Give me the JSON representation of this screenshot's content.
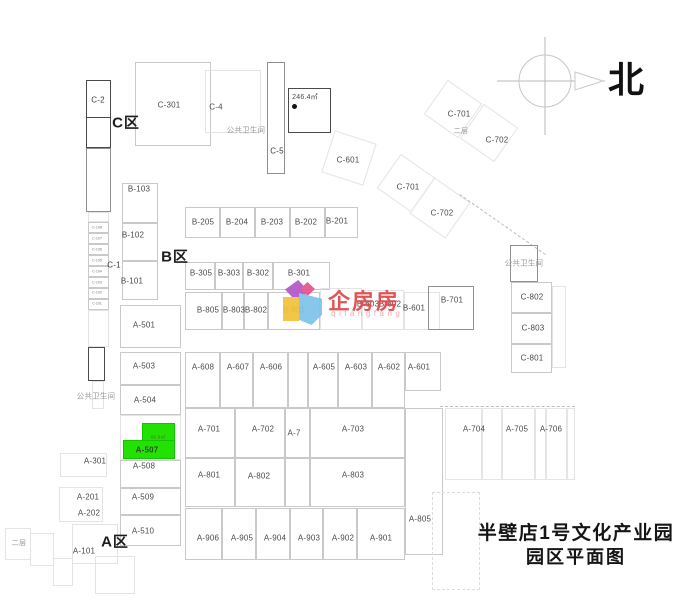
{
  "title": {
    "line1": "半壁店1号文化产业园",
    "line2": "园区平面图"
  },
  "north": {
    "label": "北"
  },
  "watermark": {
    "brand": "企房房",
    "latin": "qifangfang"
  },
  "highlight": {
    "unit": "A-507",
    "area": "66.9㎡"
  },
  "colors": {
    "highlight_green": "#23e103",
    "watermark_red": "#e0474b",
    "title_black": "#151515"
  },
  "labels": [
    {
      "t": "C-2",
      "x": 98,
      "y": 100,
      "c": "s"
    },
    {
      "t": "C区",
      "x": 126,
      "y": 122,
      "c": "zone",
      "n": "zone-c-label"
    },
    {
      "t": "C-301",
      "x": 169,
      "y": 105
    },
    {
      "t": "C-4",
      "x": 216,
      "y": 107
    },
    {
      "t": "公共卫生间",
      "x": 246,
      "y": 130,
      "c": "gray",
      "n": "public-toilet-top-label"
    },
    {
      "t": "C-5",
      "x": 277,
      "y": 151,
      "c": "s"
    },
    {
      "t": "246.4㎡",
      "x": 305,
      "y": 97,
      "c": "xs",
      "n": "area-246-label"
    },
    {
      "t": "C-601",
      "x": 348,
      "y": 160
    },
    {
      "t": "C-701",
      "x": 459,
      "y": 114
    },
    {
      "t": "二层",
      "x": 461,
      "y": 131,
      "c": "xs gray",
      "n": "second-floor-top-label"
    },
    {
      "t": "C-702",
      "x": 497,
      "y": 140
    },
    {
      "t": "C-701",
      "x": 408,
      "y": 187,
      "n": "label-c-701-lower"
    },
    {
      "t": "C-702",
      "x": 442,
      "y": 213,
      "n": "label-c-702-lower"
    },
    {
      "t": "C-1",
      "x": 114,
      "y": 265,
      "c": "s"
    },
    {
      "t": "C-108",
      "x": 97,
      "y": 228,
      "c": "tiny"
    },
    {
      "t": "C-107",
      "x": 97,
      "y": 239,
      "c": "tiny"
    },
    {
      "t": "C-106",
      "x": 97,
      "y": 250,
      "c": "tiny"
    },
    {
      "t": "C-105",
      "x": 97,
      "y": 261,
      "c": "tiny"
    },
    {
      "t": "C-104",
      "x": 97,
      "y": 272,
      "c": "tiny"
    },
    {
      "t": "C-103",
      "x": 97,
      "y": 283,
      "c": "tiny"
    },
    {
      "t": "C-102",
      "x": 97,
      "y": 293,
      "c": "tiny"
    },
    {
      "t": "C-101",
      "x": 97,
      "y": 304,
      "c": "tiny"
    },
    {
      "t": "B-103",
      "x": 139,
      "y": 189
    },
    {
      "t": "B-102",
      "x": 133,
      "y": 235
    },
    {
      "t": "B区",
      "x": 175,
      "y": 256,
      "c": "zone",
      "n": "zone-b-label"
    },
    {
      "t": "B-101",
      "x": 132,
      "y": 281
    },
    {
      "t": "B-205",
      "x": 203,
      "y": 222
    },
    {
      "t": "B-204",
      "x": 237,
      "y": 222
    },
    {
      "t": "B-203",
      "x": 272,
      "y": 222
    },
    {
      "t": "B-202",
      "x": 306,
      "y": 222
    },
    {
      "t": "B-201",
      "x": 337,
      "y": 221
    },
    {
      "t": "B-305",
      "x": 201,
      "y": 273
    },
    {
      "t": "B-303",
      "x": 229,
      "y": 273
    },
    {
      "t": "B-302",
      "x": 258,
      "y": 273
    },
    {
      "t": "B-301",
      "x": 299,
      "y": 273
    },
    {
      "t": "B-805",
      "x": 208,
      "y": 310
    },
    {
      "t": "B-803",
      "x": 234,
      "y": 310
    },
    {
      "t": "B-802",
      "x": 256,
      "y": 310
    },
    {
      "t": "B-801",
      "x": 294,
      "y": 310
    },
    {
      "t": "B-603",
      "x": 368,
      "y": 304
    },
    {
      "t": "B-602",
      "x": 390,
      "y": 304
    },
    {
      "t": "B-601",
      "x": 414,
      "y": 308
    },
    {
      "t": "B-701",
      "x": 452,
      "y": 300
    },
    {
      "t": "公共卫生间",
      "x": 524,
      "y": 263,
      "c": "gray",
      "n": "public-toilet-right-label"
    },
    {
      "t": "C-802",
      "x": 532,
      "y": 297
    },
    {
      "t": "C-803",
      "x": 533,
      "y": 328
    },
    {
      "t": "C-801",
      "x": 532,
      "y": 358
    },
    {
      "t": "A-501",
      "x": 144,
      "y": 325
    },
    {
      "t": "A-503",
      "x": 144,
      "y": 366
    },
    {
      "t": "A-504",
      "x": 145,
      "y": 400
    },
    {
      "t": "公共卫生间",
      "x": 96,
      "y": 396,
      "c": "gray",
      "n": "public-toilet-left-label"
    },
    {
      "t": "66.9㎡",
      "x": 158,
      "y": 437,
      "c": "hla",
      "n": "highlight-area-label"
    },
    {
      "t": "A-507",
      "x": 147,
      "y": 450,
      "c": "hl",
      "n": "highlight-unit-label"
    },
    {
      "t": "A-508",
      "x": 144,
      "y": 466
    },
    {
      "t": "A-509",
      "x": 143,
      "y": 497
    },
    {
      "t": "A-510",
      "x": 143,
      "y": 531
    },
    {
      "t": "A-301",
      "x": 95,
      "y": 461
    },
    {
      "t": "A-201",
      "x": 88,
      "y": 497
    },
    {
      "t": "A-202",
      "x": 89,
      "y": 513
    },
    {
      "t": "A区",
      "x": 115,
      "y": 541,
      "c": "zone",
      "n": "zone-a-label"
    },
    {
      "t": "A-101",
      "x": 84,
      "y": 551
    },
    {
      "t": "二层",
      "x": 19,
      "y": 543,
      "c": "xs gray",
      "n": "second-floor-bottom-label"
    },
    {
      "t": "A-608",
      "x": 203,
      "y": 367
    },
    {
      "t": "A-607",
      "x": 238,
      "y": 367
    },
    {
      "t": "A-606",
      "x": 271,
      "y": 367
    },
    {
      "t": "A-605",
      "x": 324,
      "y": 367
    },
    {
      "t": "A-603",
      "x": 356,
      "y": 367
    },
    {
      "t": "A-602",
      "x": 389,
      "y": 367
    },
    {
      "t": "A-601",
      "x": 419,
      "y": 367
    },
    {
      "t": "A-701",
      "x": 209,
      "y": 429
    },
    {
      "t": "A-702",
      "x": 263,
      "y": 429
    },
    {
      "t": "A-7",
      "x": 294,
      "y": 433
    },
    {
      "t": "A-703",
      "x": 353,
      "y": 429
    },
    {
      "t": "A-704",
      "x": 474,
      "y": 429
    },
    {
      "t": "A-705",
      "x": 517,
      "y": 429
    },
    {
      "t": "A-706",
      "x": 551,
      "y": 429
    },
    {
      "t": "A-801",
      "x": 209,
      "y": 475
    },
    {
      "t": "A-802",
      "x": 259,
      "y": 476
    },
    {
      "t": "A-803",
      "x": 353,
      "y": 475
    },
    {
      "t": "A-805",
      "x": 420,
      "y": 519
    },
    {
      "t": "A-906",
      "x": 208,
      "y": 538
    },
    {
      "t": "A-905",
      "x": 242,
      "y": 538
    },
    {
      "t": "A-904",
      "x": 275,
      "y": 538
    },
    {
      "t": "A-903",
      "x": 309,
      "y": 538
    },
    {
      "t": "A-902",
      "x": 343,
      "y": 538
    },
    {
      "t": "A-901",
      "x": 381,
      "y": 538
    }
  ],
  "boxes": [
    {
      "x": 86,
      "y": 80,
      "w": 25,
      "h": 68,
      "c": "d",
      "n": "c-2-strip-outline"
    },
    {
      "x": 86,
      "y": 80,
      "w": 25,
      "h": 38,
      "c": "d"
    },
    {
      "x": 86,
      "y": 148,
      "w": 25,
      "h": 64,
      "c": "m"
    },
    {
      "x": 88,
      "y": 212,
      "w": 21,
      "h": 10,
      "c": "f"
    },
    {
      "x": 88,
      "y": 222,
      "w": 21,
      "h": 11,
      "c": "l"
    },
    {
      "x": 88,
      "y": 233,
      "w": 21,
      "h": 11,
      "c": "l"
    },
    {
      "x": 88,
      "y": 244,
      "w": 21,
      "h": 11,
      "c": "l"
    },
    {
      "x": 88,
      "y": 255,
      "w": 21,
      "h": 11,
      "c": "l"
    },
    {
      "x": 88,
      "y": 266,
      "w": 21,
      "h": 11,
      "c": "l"
    },
    {
      "x": 88,
      "y": 277,
      "w": 21,
      "h": 11,
      "c": "l"
    },
    {
      "x": 88,
      "y": 288,
      "w": 21,
      "h": 11,
      "c": "l"
    },
    {
      "x": 88,
      "y": 299,
      "w": 21,
      "h": 11,
      "c": "l"
    },
    {
      "x": 88,
      "y": 310,
      "w": 21,
      "h": 37,
      "c": "f"
    },
    {
      "x": 88,
      "y": 347,
      "w": 17,
      "h": 34,
      "c": "d",
      "n": "toilet-left-outline"
    },
    {
      "x": 92,
      "y": 381,
      "w": 12,
      "h": 28,
      "c": "f"
    },
    {
      "x": 135,
      "y": 62,
      "w": 76,
      "h": 84,
      "c": "l",
      "n": "c-301-outline"
    },
    {
      "x": 205,
      "y": 70,
      "w": 56,
      "h": 63,
      "c": "f",
      "n": "c-4-outline"
    },
    {
      "x": 267,
      "y": 62,
      "w": 18,
      "h": 112,
      "c": "m",
      "n": "c-5-outline"
    },
    {
      "x": 288,
      "y": 88,
      "w": 43,
      "h": 45,
      "c": "d",
      "n": "area-246-outline"
    },
    {
      "x": 292,
      "y": 104,
      "w": 5,
      "h": 5,
      "c": "dot",
      "n": "area-246-dot"
    },
    {
      "x": 327,
      "y": 136,
      "w": 44,
      "h": 44,
      "c": "f",
      "r": 18,
      "n": "c-601-outline"
    },
    {
      "x": 432,
      "y": 88,
      "w": 42,
      "h": 42,
      "c": "f",
      "r": 35,
      "n": "c-701-outline"
    },
    {
      "x": 468,
      "y": 112,
      "w": 42,
      "h": 42,
      "c": "f",
      "r": 35,
      "n": "c-702-outline"
    },
    {
      "x": 385,
      "y": 162,
      "w": 42,
      "h": 42,
      "c": "f",
      "r": 35,
      "n": "c-701-lower-outline"
    },
    {
      "x": 418,
      "y": 186,
      "w": 44,
      "h": 44,
      "c": "f",
      "r": 35,
      "n": "c-702-lower-outline"
    },
    {
      "x": 450,
      "y": 224,
      "w": 105,
      "h": 1,
      "c": "hdash",
      "r": 35,
      "n": "boundary-dashed-line"
    },
    {
      "x": 122,
      "y": 183,
      "w": 36,
      "h": 40,
      "c": "l",
      "n": "b-103-outline"
    },
    {
      "x": 122,
      "y": 223,
      "w": 36,
      "h": 38,
      "c": "l",
      "n": "b-102-outline"
    },
    {
      "x": 122,
      "y": 261,
      "w": 36,
      "h": 39,
      "c": "l",
      "n": "b-101-outline"
    },
    {
      "x": 185,
      "y": 207,
      "w": 35,
      "h": 31,
      "c": "l"
    },
    {
      "x": 220,
      "y": 207,
      "w": 35,
      "h": 31,
      "c": "l"
    },
    {
      "x": 255,
      "y": 207,
      "w": 35,
      "h": 31,
      "c": "l"
    },
    {
      "x": 290,
      "y": 207,
      "w": 35,
      "h": 31,
      "c": "l"
    },
    {
      "x": 325,
      "y": 207,
      "w": 33,
      "h": 31,
      "c": "l"
    },
    {
      "x": 185,
      "y": 262,
      "w": 30,
      "h": 28,
      "c": "l"
    },
    {
      "x": 215,
      "y": 262,
      "w": 28,
      "h": 28,
      "c": "l"
    },
    {
      "x": 243,
      "y": 262,
      "w": 30,
      "h": 28,
      "c": "l"
    },
    {
      "x": 273,
      "y": 262,
      "w": 57,
      "h": 28,
      "c": "l"
    },
    {
      "x": 185,
      "y": 292,
      "w": 37,
      "h": 38,
      "c": "l"
    },
    {
      "x": 222,
      "y": 292,
      "w": 22,
      "h": 38,
      "c": "l"
    },
    {
      "x": 244,
      "y": 292,
      "w": 24,
      "h": 38,
      "c": "l"
    },
    {
      "x": 268,
      "y": 292,
      "w": 52,
      "h": 38,
      "c": "l"
    },
    {
      "x": 320,
      "y": 288,
      "w": 42,
      "h": 42,
      "c": "f"
    },
    {
      "x": 362,
      "y": 290,
      "w": 42,
      "h": 40,
      "c": "f"
    },
    {
      "x": 404,
      "y": 292,
      "w": 36,
      "h": 38,
      "c": "f"
    },
    {
      "x": 428,
      "y": 286,
      "w": 46,
      "h": 44,
      "c": "m",
      "n": "b-701-outline"
    },
    {
      "x": 510,
      "y": 245,
      "w": 28,
      "h": 37,
      "c": "m",
      "n": "toilet-right-outline"
    },
    {
      "x": 511,
      "y": 282,
      "w": 41,
      "h": 31,
      "c": "l",
      "n": "c-802-outline"
    },
    {
      "x": 511,
      "y": 313,
      "w": 41,
      "h": 31,
      "c": "l",
      "n": "c-803-outline"
    },
    {
      "x": 511,
      "y": 344,
      "w": 41,
      "h": 29,
      "c": "l",
      "n": "c-801-outline"
    },
    {
      "x": 552,
      "y": 286,
      "w": 14,
      "h": 82,
      "c": "f"
    },
    {
      "x": 120,
      "y": 305,
      "w": 61,
      "h": 43,
      "c": "l",
      "n": "a-501-outline"
    },
    {
      "x": 120,
      "y": 352,
      "w": 61,
      "h": 33,
      "c": "l",
      "n": "a-503-outline"
    },
    {
      "x": 120,
      "y": 385,
      "w": 61,
      "h": 30,
      "c": "l",
      "n": "a-504-outline"
    },
    {
      "x": 120,
      "y": 415,
      "w": 61,
      "h": 45,
      "c": "f"
    },
    {
      "x": 120,
      "y": 460,
      "w": 61,
      "h": 28,
      "c": "l",
      "n": "a-508-outline"
    },
    {
      "x": 120,
      "y": 488,
      "w": 61,
      "h": 27,
      "c": "l",
      "n": "a-509-outline"
    },
    {
      "x": 120,
      "y": 515,
      "w": 61,
      "h": 31,
      "c": "l",
      "n": "a-510-outline"
    },
    {
      "x": 142,
      "y": 423,
      "w": 33,
      "h": 18,
      "c": "g",
      "n": "highlighted-unit-a-507",
      "i": true
    },
    {
      "x": 123,
      "y": 440,
      "w": 52,
      "h": 19,
      "c": "g",
      "n": "highlighted-unit-a-507",
      "i": true
    },
    {
      "x": 185,
      "y": 352,
      "w": 35,
      "h": 56,
      "c": "l"
    },
    {
      "x": 220,
      "y": 352,
      "w": 33,
      "h": 56,
      "c": "l"
    },
    {
      "x": 253,
      "y": 352,
      "w": 35,
      "h": 56,
      "c": "l"
    },
    {
      "x": 288,
      "y": 352,
      "w": 20,
      "h": 56,
      "c": "l"
    },
    {
      "x": 308,
      "y": 352,
      "w": 30,
      "h": 56,
      "c": "l"
    },
    {
      "x": 338,
      "y": 352,
      "w": 34,
      "h": 56,
      "c": "l"
    },
    {
      "x": 372,
      "y": 352,
      "w": 33,
      "h": 56,
      "c": "l"
    },
    {
      "x": 405,
      "y": 352,
      "w": 36,
      "h": 39,
      "c": "l",
      "n": "a-601-outline"
    },
    {
      "x": 185,
      "y": 408,
      "w": 50,
      "h": 50,
      "c": "l"
    },
    {
      "x": 235,
      "y": 408,
      "w": 50,
      "h": 50,
      "c": "l"
    },
    {
      "x": 285,
      "y": 408,
      "w": 25,
      "h": 50,
      "c": "l"
    },
    {
      "x": 310,
      "y": 408,
      "w": 95,
      "h": 50,
      "c": "l"
    },
    {
      "x": 185,
      "y": 458,
      "w": 50,
      "h": 49,
      "c": "l"
    },
    {
      "x": 235,
      "y": 458,
      "w": 50,
      "h": 49,
      "c": "l"
    },
    {
      "x": 285,
      "y": 458,
      "w": 25,
      "h": 49,
      "c": "l"
    },
    {
      "x": 310,
      "y": 458,
      "w": 95,
      "h": 49,
      "c": "l"
    },
    {
      "x": 405,
      "y": 408,
      "w": 38,
      "h": 147,
      "c": "l",
      "n": "a-805-outline"
    },
    {
      "x": 185,
      "y": 508,
      "w": 37,
      "h": 52,
      "c": "l"
    },
    {
      "x": 222,
      "y": 508,
      "w": 34,
      "h": 52,
      "c": "l"
    },
    {
      "x": 256,
      "y": 508,
      "w": 34,
      "h": 52,
      "c": "l"
    },
    {
      "x": 290,
      "y": 508,
      "w": 33,
      "h": 52,
      "c": "l"
    },
    {
      "x": 323,
      "y": 508,
      "w": 34,
      "h": 52,
      "c": "l"
    },
    {
      "x": 357,
      "y": 508,
      "w": 48,
      "h": 52,
      "c": "l"
    },
    {
      "x": 440,
      "y": 406,
      "w": 135,
      "h": 1,
      "c": "hdash"
    },
    {
      "x": 445,
      "y": 408,
      "w": 37,
      "h": 72,
      "c": "f"
    },
    {
      "x": 482,
      "y": 408,
      "w": 20,
      "h": 72,
      "c": "f"
    },
    {
      "x": 502,
      "y": 408,
      "w": 33,
      "h": 72,
      "c": "f"
    },
    {
      "x": 535,
      "y": 408,
      "w": 11,
      "h": 72,
      "c": "f"
    },
    {
      "x": 546,
      "y": 408,
      "w": 21,
      "h": 72,
      "c": "f"
    },
    {
      "x": 567,
      "y": 408,
      "w": 8,
      "h": 72,
      "c": "f"
    },
    {
      "x": 60,
      "y": 453,
      "w": 47,
      "h": 24,
      "c": "f"
    },
    {
      "x": 59,
      "y": 487,
      "w": 44,
      "h": 35,
      "c": "f"
    },
    {
      "x": 30,
      "y": 533,
      "w": 24,
      "h": 33,
      "c": "f"
    },
    {
      "x": 53,
      "y": 558,
      "w": 20,
      "h": 28,
      "c": "f"
    },
    {
      "x": 72,
      "y": 524,
      "w": 46,
      "h": 40,
      "c": "f"
    },
    {
      "x": 5,
      "y": 528,
      "w": 26,
      "h": 32,
      "c": "f"
    },
    {
      "x": 95,
      "y": 556,
      "w": 40,
      "h": 38,
      "c": "f"
    },
    {
      "x": 432,
      "y": 492,
      "w": 48,
      "h": 98,
      "c": "vdash"
    }
  ]
}
